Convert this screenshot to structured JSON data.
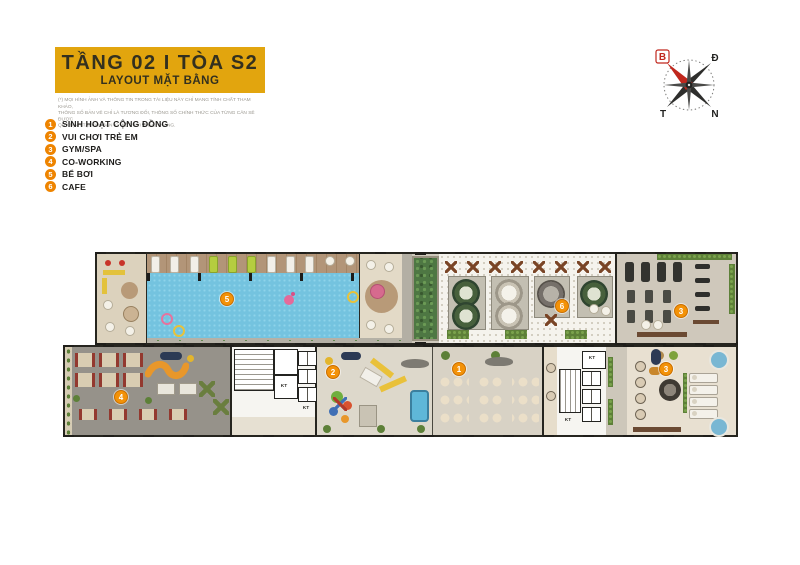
{
  "header": {
    "title": "TẦNG 02 I TÒA S2",
    "subtitle": "LAYOUT MẶT BẰNG",
    "disclaimer_lines": [
      "(*) MỌI HÌNH ẢNH VÀ THÔNG TIN TRONG TÀI LIỆU NÀY CHỈ MANG TÍNH CHẤT THAM KHẢO,",
      "THÔNG SỐ BẢN VẼ CHỈ LÀ TƯƠNG ĐỐI, THÔNG SỐ CHÍNH THỨC CỦA TỪNG CĂN SẼ ĐƯỢC",
      "QUY ĐỊNH TẠI VĂN BẢN KÝ KẾT VỚI KHÁCH HÀNG."
    ]
  },
  "legend": {
    "items": [
      {
        "num": "1",
        "label": "SINH HOẠT CỘNG ĐỒNG"
      },
      {
        "num": "2",
        "label": "VUI CHƠI TRẺ EM"
      },
      {
        "num": "3",
        "label": "GYM/SPA"
      },
      {
        "num": "4",
        "label": "CO-WORKING"
      },
      {
        "num": "5",
        "label": "BỂ BƠI"
      },
      {
        "num": "6",
        "label": "CAFE"
      }
    ]
  },
  "compass": {
    "north": "B",
    "east": "Đ",
    "west": "T",
    "south": "N"
  },
  "plan": {
    "markers": [
      {
        "num": "1",
        "area": "sinh hoạt cộng đồng"
      },
      {
        "num": "2",
        "area": "vui chơi trẻ em"
      },
      {
        "num": "3",
        "area": "gym"
      },
      {
        "num": "3",
        "area": "spa"
      },
      {
        "num": "4",
        "area": "co-working"
      },
      {
        "num": "5",
        "area": "bể bơi"
      },
      {
        "num": "6",
        "area": "cafe"
      }
    ],
    "room_label_kt": "KT"
  },
  "colors": {
    "accent_yellow": "#E2A50E",
    "accent_orange": "#EE8400",
    "marker_orange": "#F39208",
    "pool_blue": "#74C3DF",
    "compass_red": "#C0271D"
  }
}
